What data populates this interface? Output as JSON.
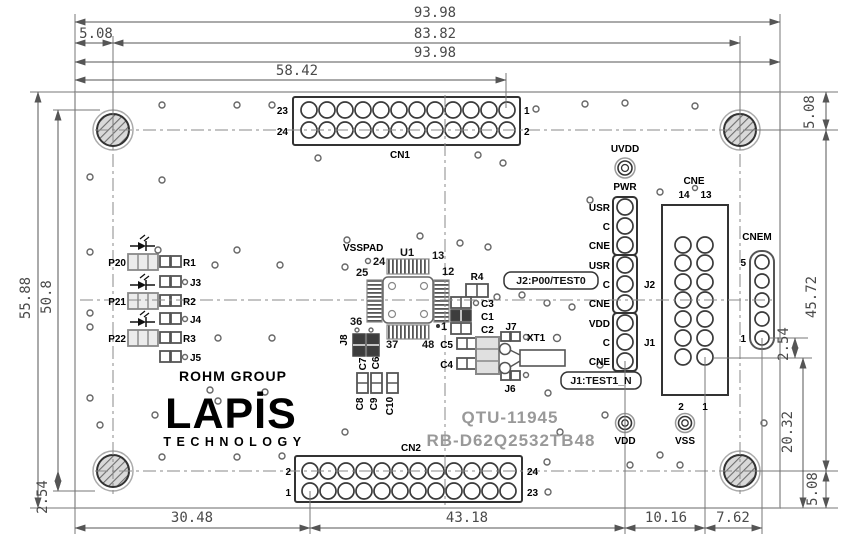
{
  "dims": {
    "w1": "93.98",
    "hole_span": "83.82",
    "edge_hole": "5.08",
    "w2": "93.98",
    "cn1_x": "58.42",
    "h": "55.88",
    "cn_rows": "50.8",
    "cn2_row": "2.54",
    "cn2_x": "30.48",
    "vdd_x": "43.18",
    "cne_x": "10.16",
    "cnem_x": "7.62",
    "r_edge_hole": "5.08",
    "r_hole_span": "45.72",
    "r_pitch": "2.54",
    "r_cne_edge": "20.32",
    "r_edge_hole_b": "5.08"
  },
  "cn1": {
    "name": "CN1",
    "p23": "23",
    "p24": "24",
    "p1": "1",
    "p2": "2"
  },
  "cn2": {
    "name": "CN2",
    "p2": "2",
    "p1": "1",
    "p24": "24",
    "p23": "23"
  },
  "pwr": {
    "uvdd": "UVDD",
    "name": "PWR",
    "l1": "USR",
    "l2": "C",
    "l3": "CNE",
    "l4": "USR",
    "l5": "C",
    "l6": "CNE",
    "l7": "VDD",
    "l8": "C",
    "l9": "CNE",
    "j2": "J2",
    "j1": "J1"
  },
  "cne": {
    "name": "CNE",
    "t14": "14",
    "t13": "13",
    "b2": "2",
    "b1": "1"
  },
  "cnem": {
    "name": "CNEM",
    "p5": "5",
    "p1": "1"
  },
  "pads": {
    "vdd": "VDD",
    "vss": "VSS"
  },
  "ic": {
    "ref": "U1",
    "vsspad": "VSSPAD",
    "p24": "24",
    "p25": "25",
    "p13": "13",
    "p12": "12",
    "p36": "36",
    "p37": "37",
    "p48": "48",
    "p1": "1"
  },
  "comps": {
    "p20": "P20",
    "p21": "P21",
    "p22": "P22",
    "r1": "R1",
    "r2": "R2",
    "r3": "R3",
    "j3": "J3",
    "j4": "J4",
    "j5": "J5",
    "r4": "R4",
    "c1": "C1",
    "c2": "C2",
    "c3": "C3",
    "c4": "C4",
    "c5": "C5",
    "c6": "C6",
    "c7": "C7",
    "c8": "C8",
    "c9": "C9",
    "c10": "C10",
    "j6": "J6",
    "j7": "J7",
    "j8": "J8",
    "xt1": "XT1"
  },
  "notes": {
    "j2": "J2:P00/TEST0",
    "j1": "J1:TEST1_N"
  },
  "logo": {
    "group": "ROHM GROUP",
    "brand": "LAPİS",
    "sub": "TECHNOLOGY"
  },
  "titles": {
    "model": "QTU-11945",
    "part": "RB-D62Q2532TB48"
  },
  "colors": {
    "line_dark": "#333",
    "line_gray": "#9a9a9a",
    "dimension": "#4a4a4a",
    "silkscreen_gray": "#999"
  }
}
